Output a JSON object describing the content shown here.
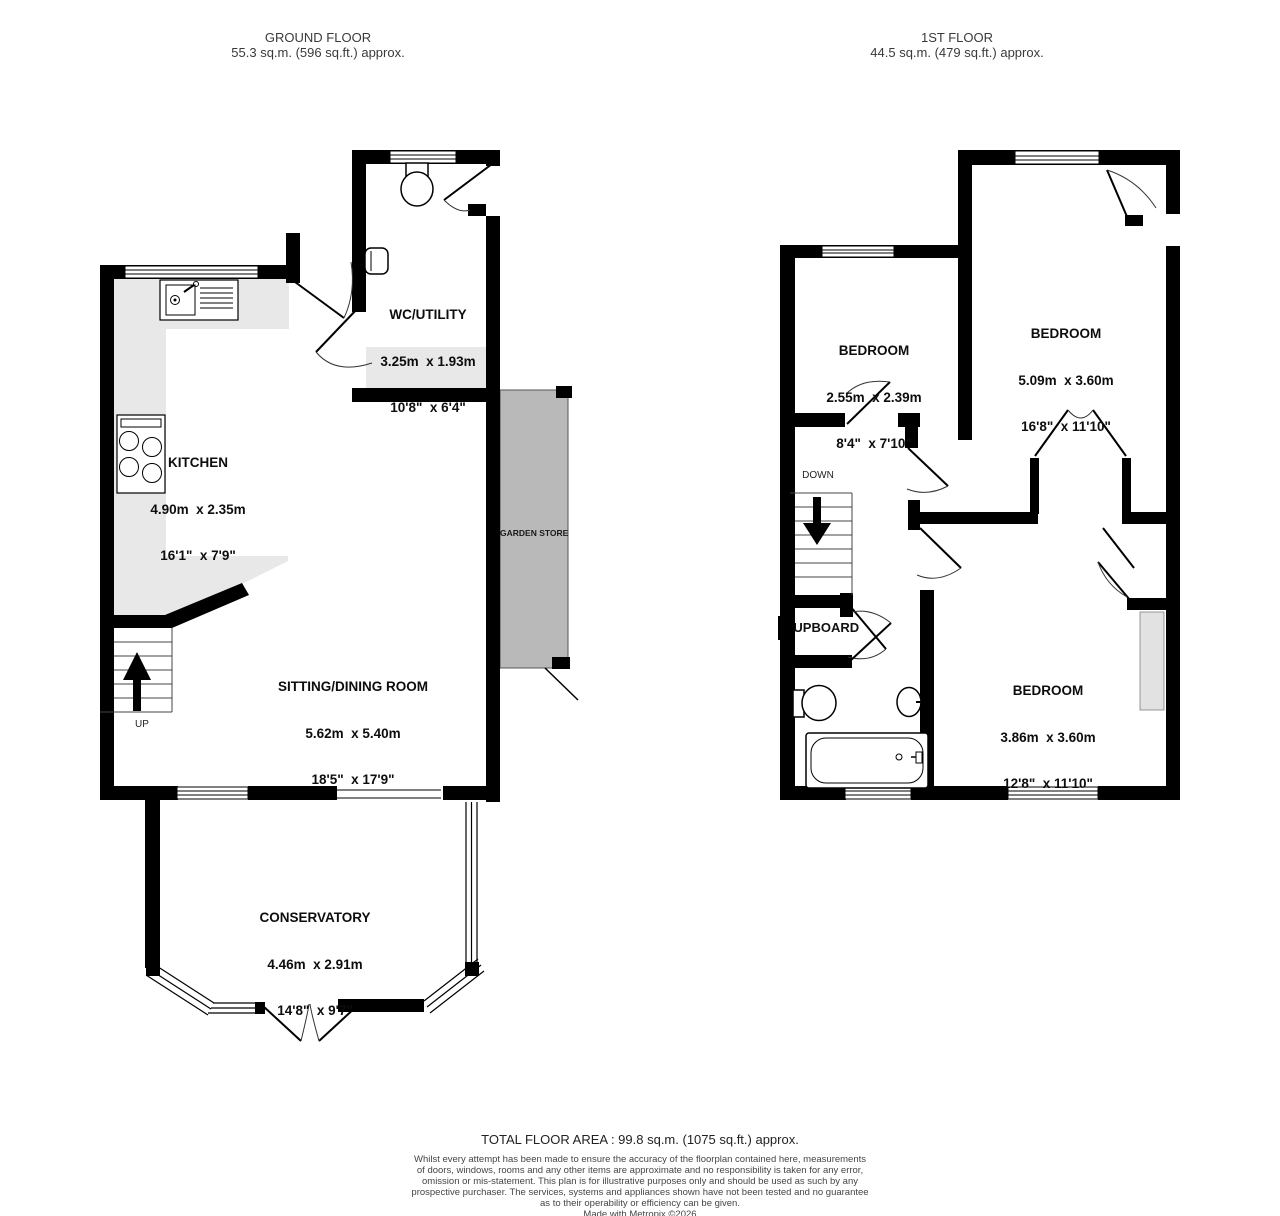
{
  "colors": {
    "wall": "#000000",
    "counter_fill": "#e8e8e8",
    "garden_store_fill": "#b9b9b9",
    "inset_fill": "#e2e2e2",
    "header_text": "#3a3a3a",
    "label_text": "#0d0d0d"
  },
  "floors": {
    "ground": {
      "title": "GROUND FLOOR",
      "area": "55.3 sq.m. (596 sq.ft.) approx.",
      "stairs_label": "UP",
      "rooms": {
        "wc_utility": {
          "name": "WC/UTILITY",
          "dims_m": "3.25m  x 1.93m",
          "dims_ft": "10'8\"  x 6'4\""
        },
        "kitchen": {
          "name": "KITCHEN",
          "dims_m": "4.90m  x 2.35m",
          "dims_ft": "16'1\"  x 7'9\""
        },
        "sitting_dining": {
          "name": "SITTING/DINING ROOM",
          "dims_m": "5.62m  x 5.40m",
          "dims_ft": "18'5\"  x 17'9\""
        },
        "conservatory": {
          "name": "CONSERVATORY",
          "dims_m": "4.46m  x 2.91m",
          "dims_ft": "14'8\"  x 9'7\""
        },
        "garden_store": {
          "name": "GARDEN STORE"
        }
      }
    },
    "first": {
      "title": "1ST FLOOR",
      "area": "44.5 sq.m. (479 sq.ft.) approx.",
      "stairs_label": "DOWN",
      "rooms": {
        "bedroom_front_small": {
          "name": "BEDROOM",
          "dims_m": "2.55m  x 2.39m",
          "dims_ft": "8'4\"  x 7'10\""
        },
        "bedroom_front_large": {
          "name": "BEDROOM",
          "dims_m": "5.09m  x 3.60m",
          "dims_ft": "16'8\"  x 11'10\""
        },
        "bedroom_rear": {
          "name": "BEDROOM",
          "dims_m": "3.86m  x 3.60m",
          "dims_ft": "12'8\"  x 11'10\""
        },
        "cupboard": {
          "name": "CUPBOARD"
        }
      }
    }
  },
  "footer": {
    "total_area": "TOTAL FLOOR AREA : 99.8 sq.m. (1075 sq.ft.) approx.",
    "disclaimer_lines": [
      "Whilst every attempt has been made to ensure the accuracy of the floorplan contained here, measurements",
      "of doors, windows, rooms and any other items are approximate and no responsibility is taken for any error,",
      "omission or mis-statement. This plan is for illustrative purposes only and should be used as such by any",
      "prospective purchaser. The services, systems and appliances shown have not been tested and no guarantee",
      "as to their operability or efficiency can be given."
    ],
    "credit": "Made with Metropix ©2026"
  }
}
